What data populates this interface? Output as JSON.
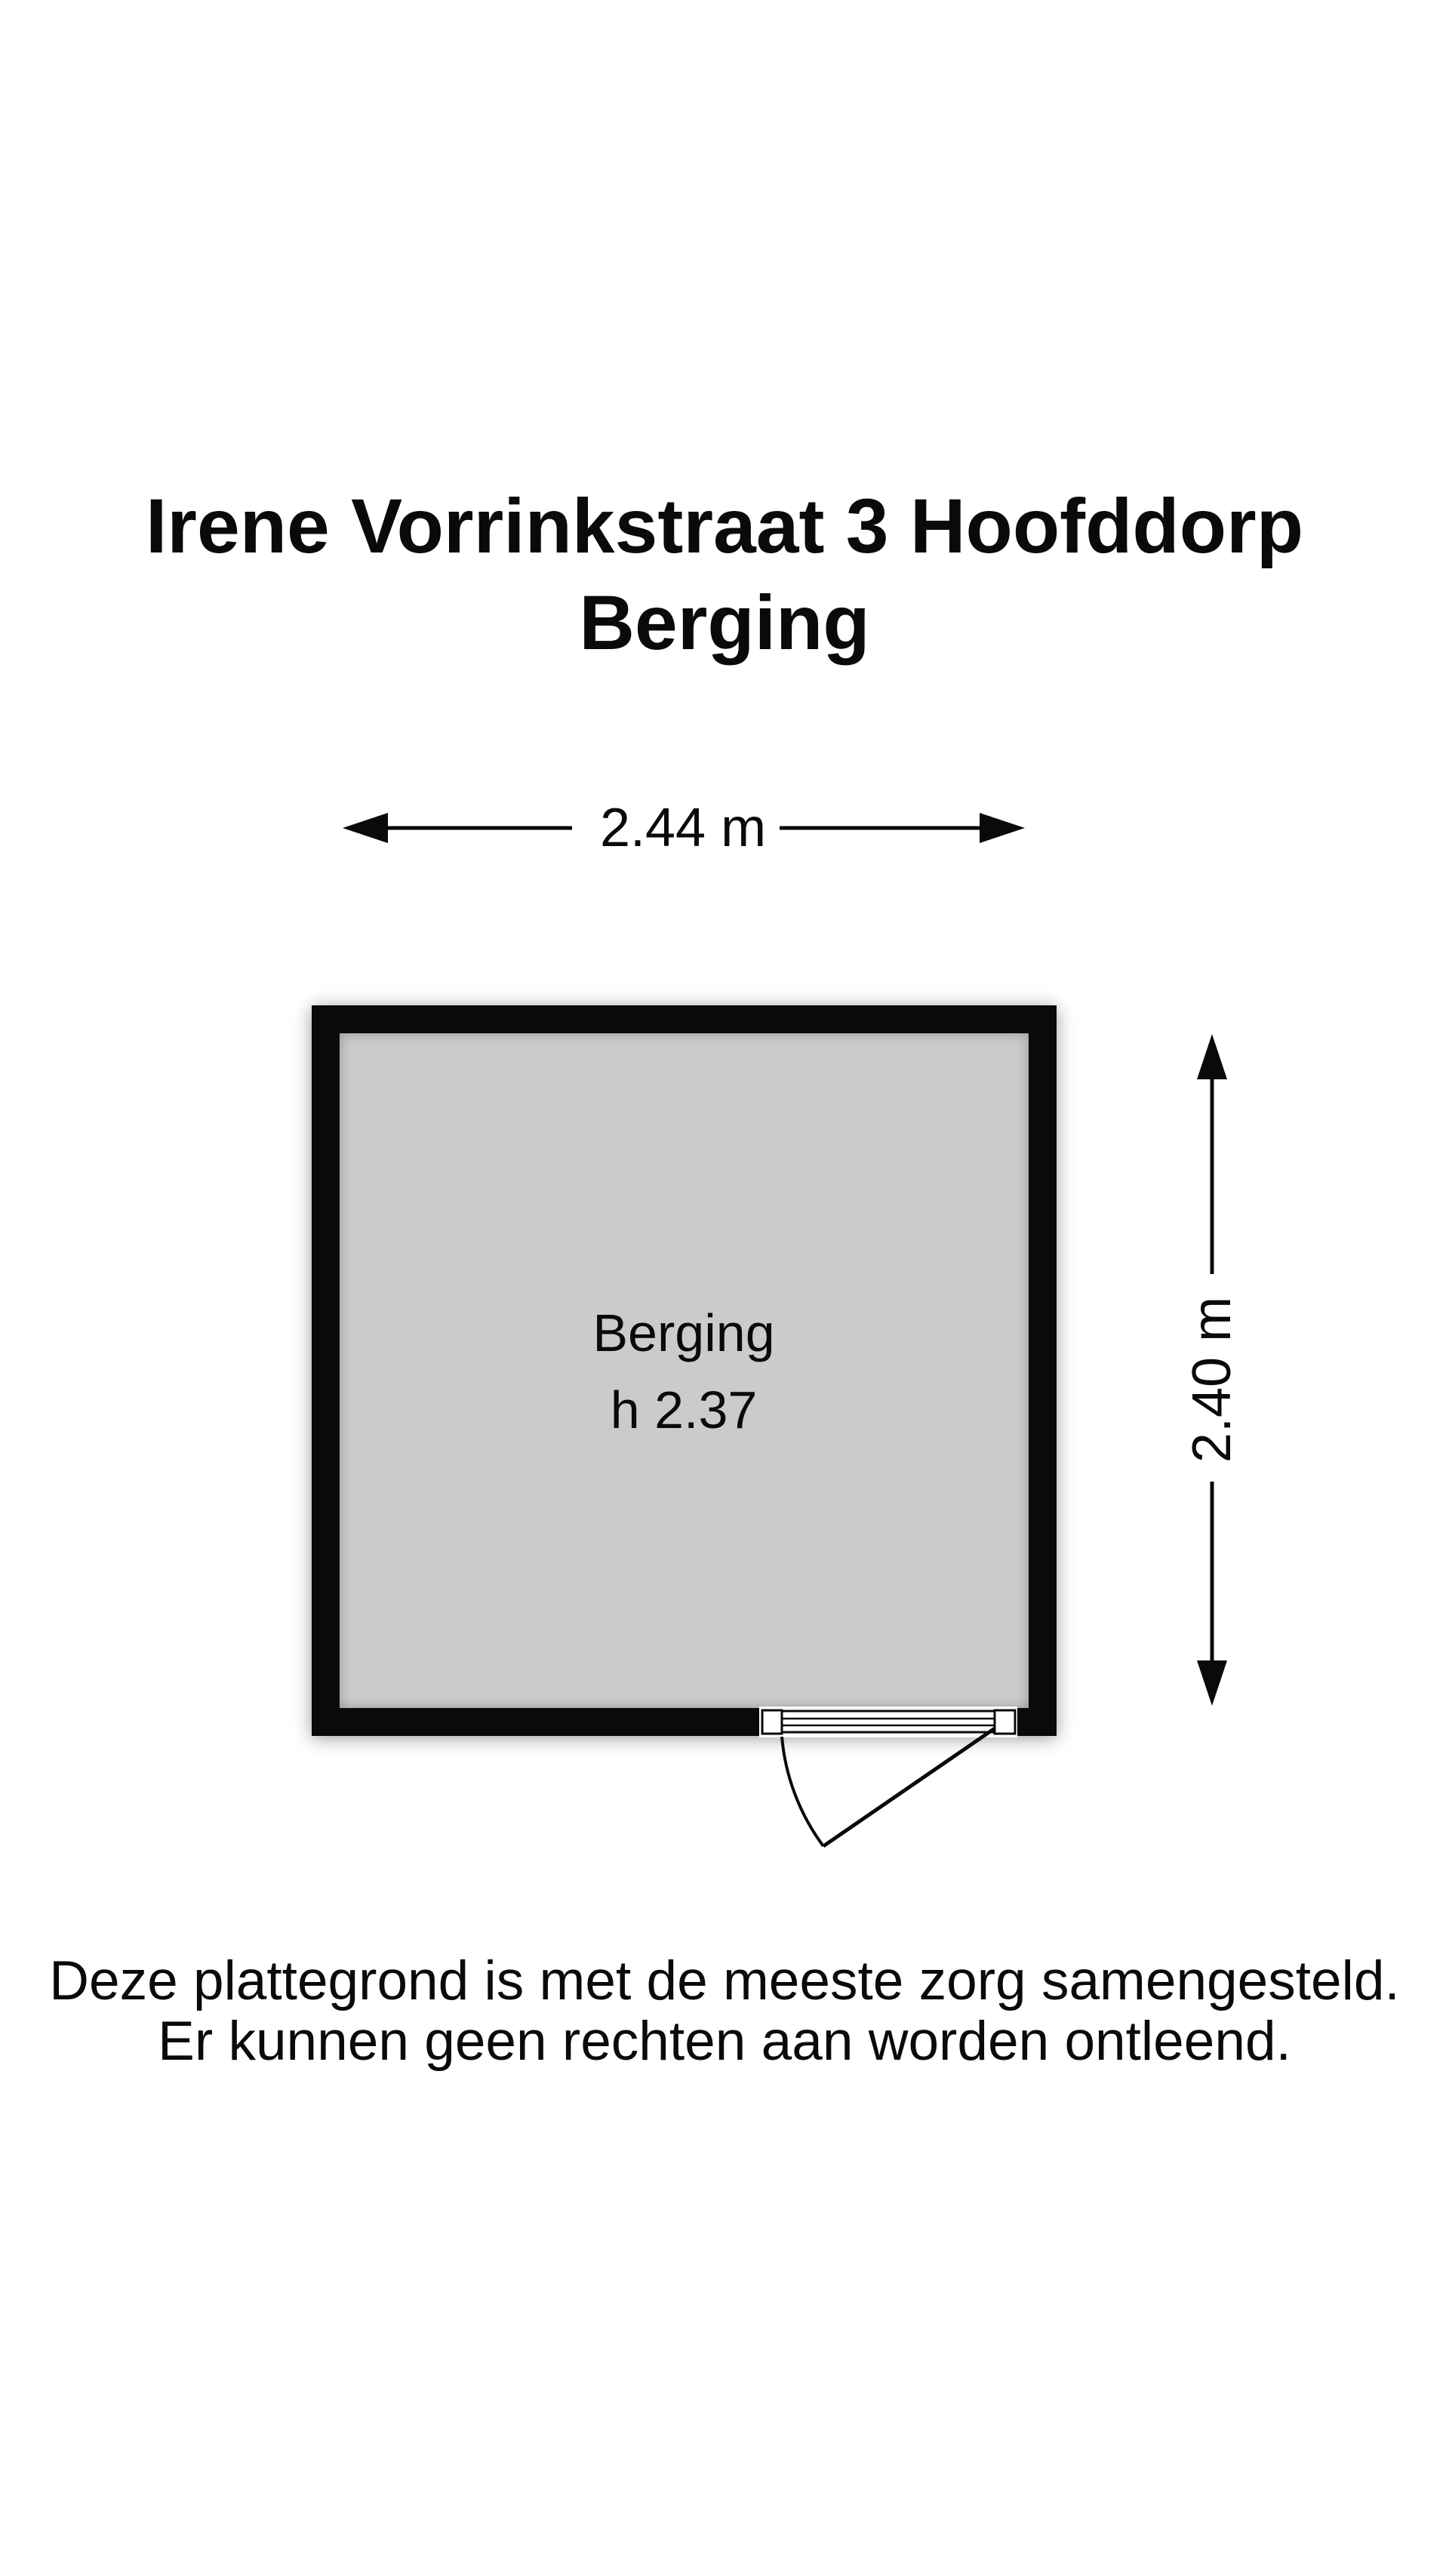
{
  "title": {
    "line1": "Irene Vorrinkstraat 3 Hoofddorp",
    "line2": "Berging"
  },
  "plan": {
    "room": {
      "name": "Berging",
      "ceiling_height_label": "h 2.37",
      "floor_color": "#cbcbcb",
      "wall_color": "#0a0a0a"
    },
    "dimensions": {
      "width_label": "2.44 m",
      "height_label": "2.40 m"
    }
  },
  "footer": {
    "line1": "Deze plattegrond is met de meeste zorg samengesteld.",
    "line2": "Er kunnen geen rechten aan worden ontleend."
  }
}
